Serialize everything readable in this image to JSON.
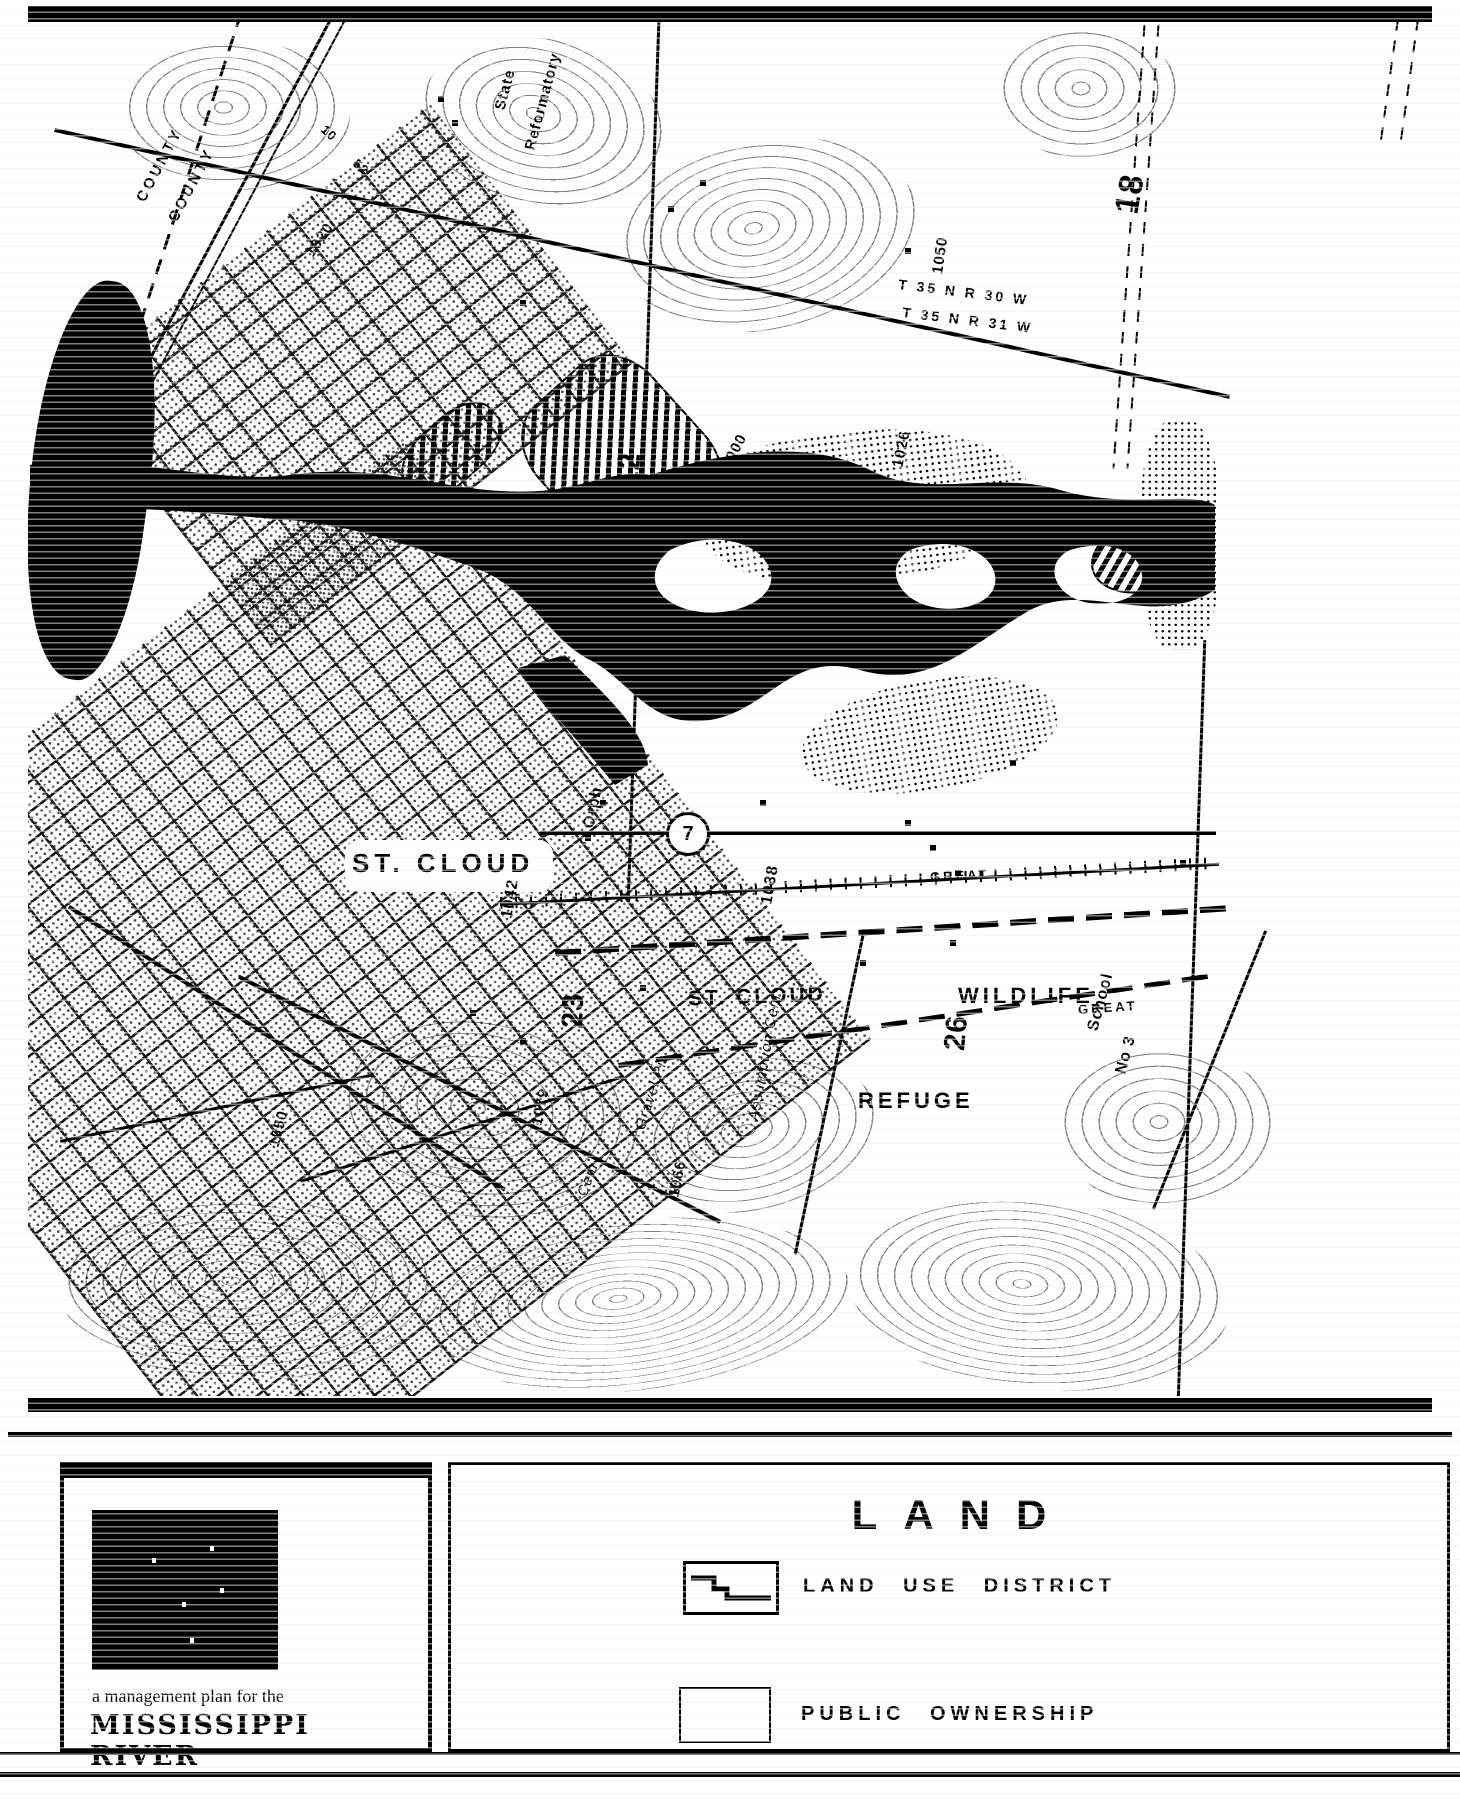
{
  "map": {
    "labels": {
      "county_a": "COUNTY",
      "county_b": "COUNTY",
      "reformatory_line1": "State",
      "reformatory_line2": "Reformatory",
      "route_10": "10",
      "route_52": "52",
      "contour_1020": "1020",
      "contour_1050_top": "1050",
      "section_18": "18",
      "township_a": "T 35 N R 30 W",
      "township_b": "T 35 N R 31 W",
      "contour_1026": "1026",
      "contour_1000": "1000",
      "section_12": "12",
      "city_label": "ST. CLOUD",
      "contour_1042": "1042",
      "orphanage": "Orph",
      "contour_1038": "1038",
      "railroad_name_a": "GREAT",
      "railroad_name_b": "GREAT",
      "city_label_2": "ST. CLOUD",
      "section_23": "23",
      "section_26": "26",
      "wildlife": "WILDLIFE",
      "refuge": "REFUGE",
      "gravel_pit": "Gravel Pit",
      "assumption_cem": "Assumption Cem",
      "school_line1": "School",
      "school_line2": "No 3",
      "contour_1066": "1066",
      "contour_1050_bottom": "1050",
      "contour_1079": "1079",
      "cemetery": "Cem"
    },
    "route_shield": {
      "number": "7"
    }
  },
  "legend": {
    "title": "LAND",
    "items": [
      {
        "label": "LAND USE DISTRICT",
        "symbol": "stepped-boundary"
      },
      {
        "label": "PUBLIC OWNERSHIP",
        "symbol": "diagonal-hatch"
      }
    ],
    "plan": {
      "line1": "a management plan for the",
      "line2": "MISSISSIPPI RIVER"
    }
  },
  "colors": {
    "ink": "#000000",
    "paper": "#ffffff"
  }
}
